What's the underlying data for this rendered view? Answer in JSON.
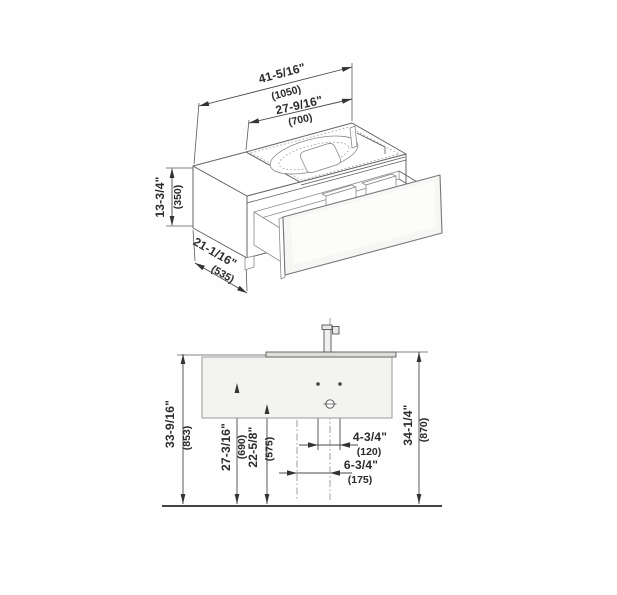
{
  "drawing": {
    "iso": {
      "overall_width_in": "41-5/16\"",
      "overall_width_mm": "(1050)",
      "cutout_width_in": "27-9/16\"",
      "cutout_width_mm": "(700)",
      "height_in": "13-3/4\"",
      "height_mm": "(350)",
      "depth_in": "21-1/16\"",
      "depth_mm": "(535)"
    },
    "front": {
      "counter_underside_height_in": "33-9/16\"",
      "counter_underside_height_mm": "(853)",
      "faucet_hole_height_in": "27-3/16\"",
      "faucet_hole_height_mm": "(690)",
      "drain_height_in": "22-5/8\"",
      "drain_height_mm": "(575)",
      "hole_spacing_in": "4-3/4\"",
      "hole_spacing_mm": "(120)",
      "drain_offset_in": "6-3/4\"",
      "drain_offset_mm": "(175)",
      "counter_top_height_in": "34-1/4\"",
      "counter_top_height_mm": "(870)"
    },
    "colors": {
      "line": "#4a4a4a",
      "panel_fill": "#f3f3f0",
      "slab_fill": "#e4e4e0"
    }
  }
}
